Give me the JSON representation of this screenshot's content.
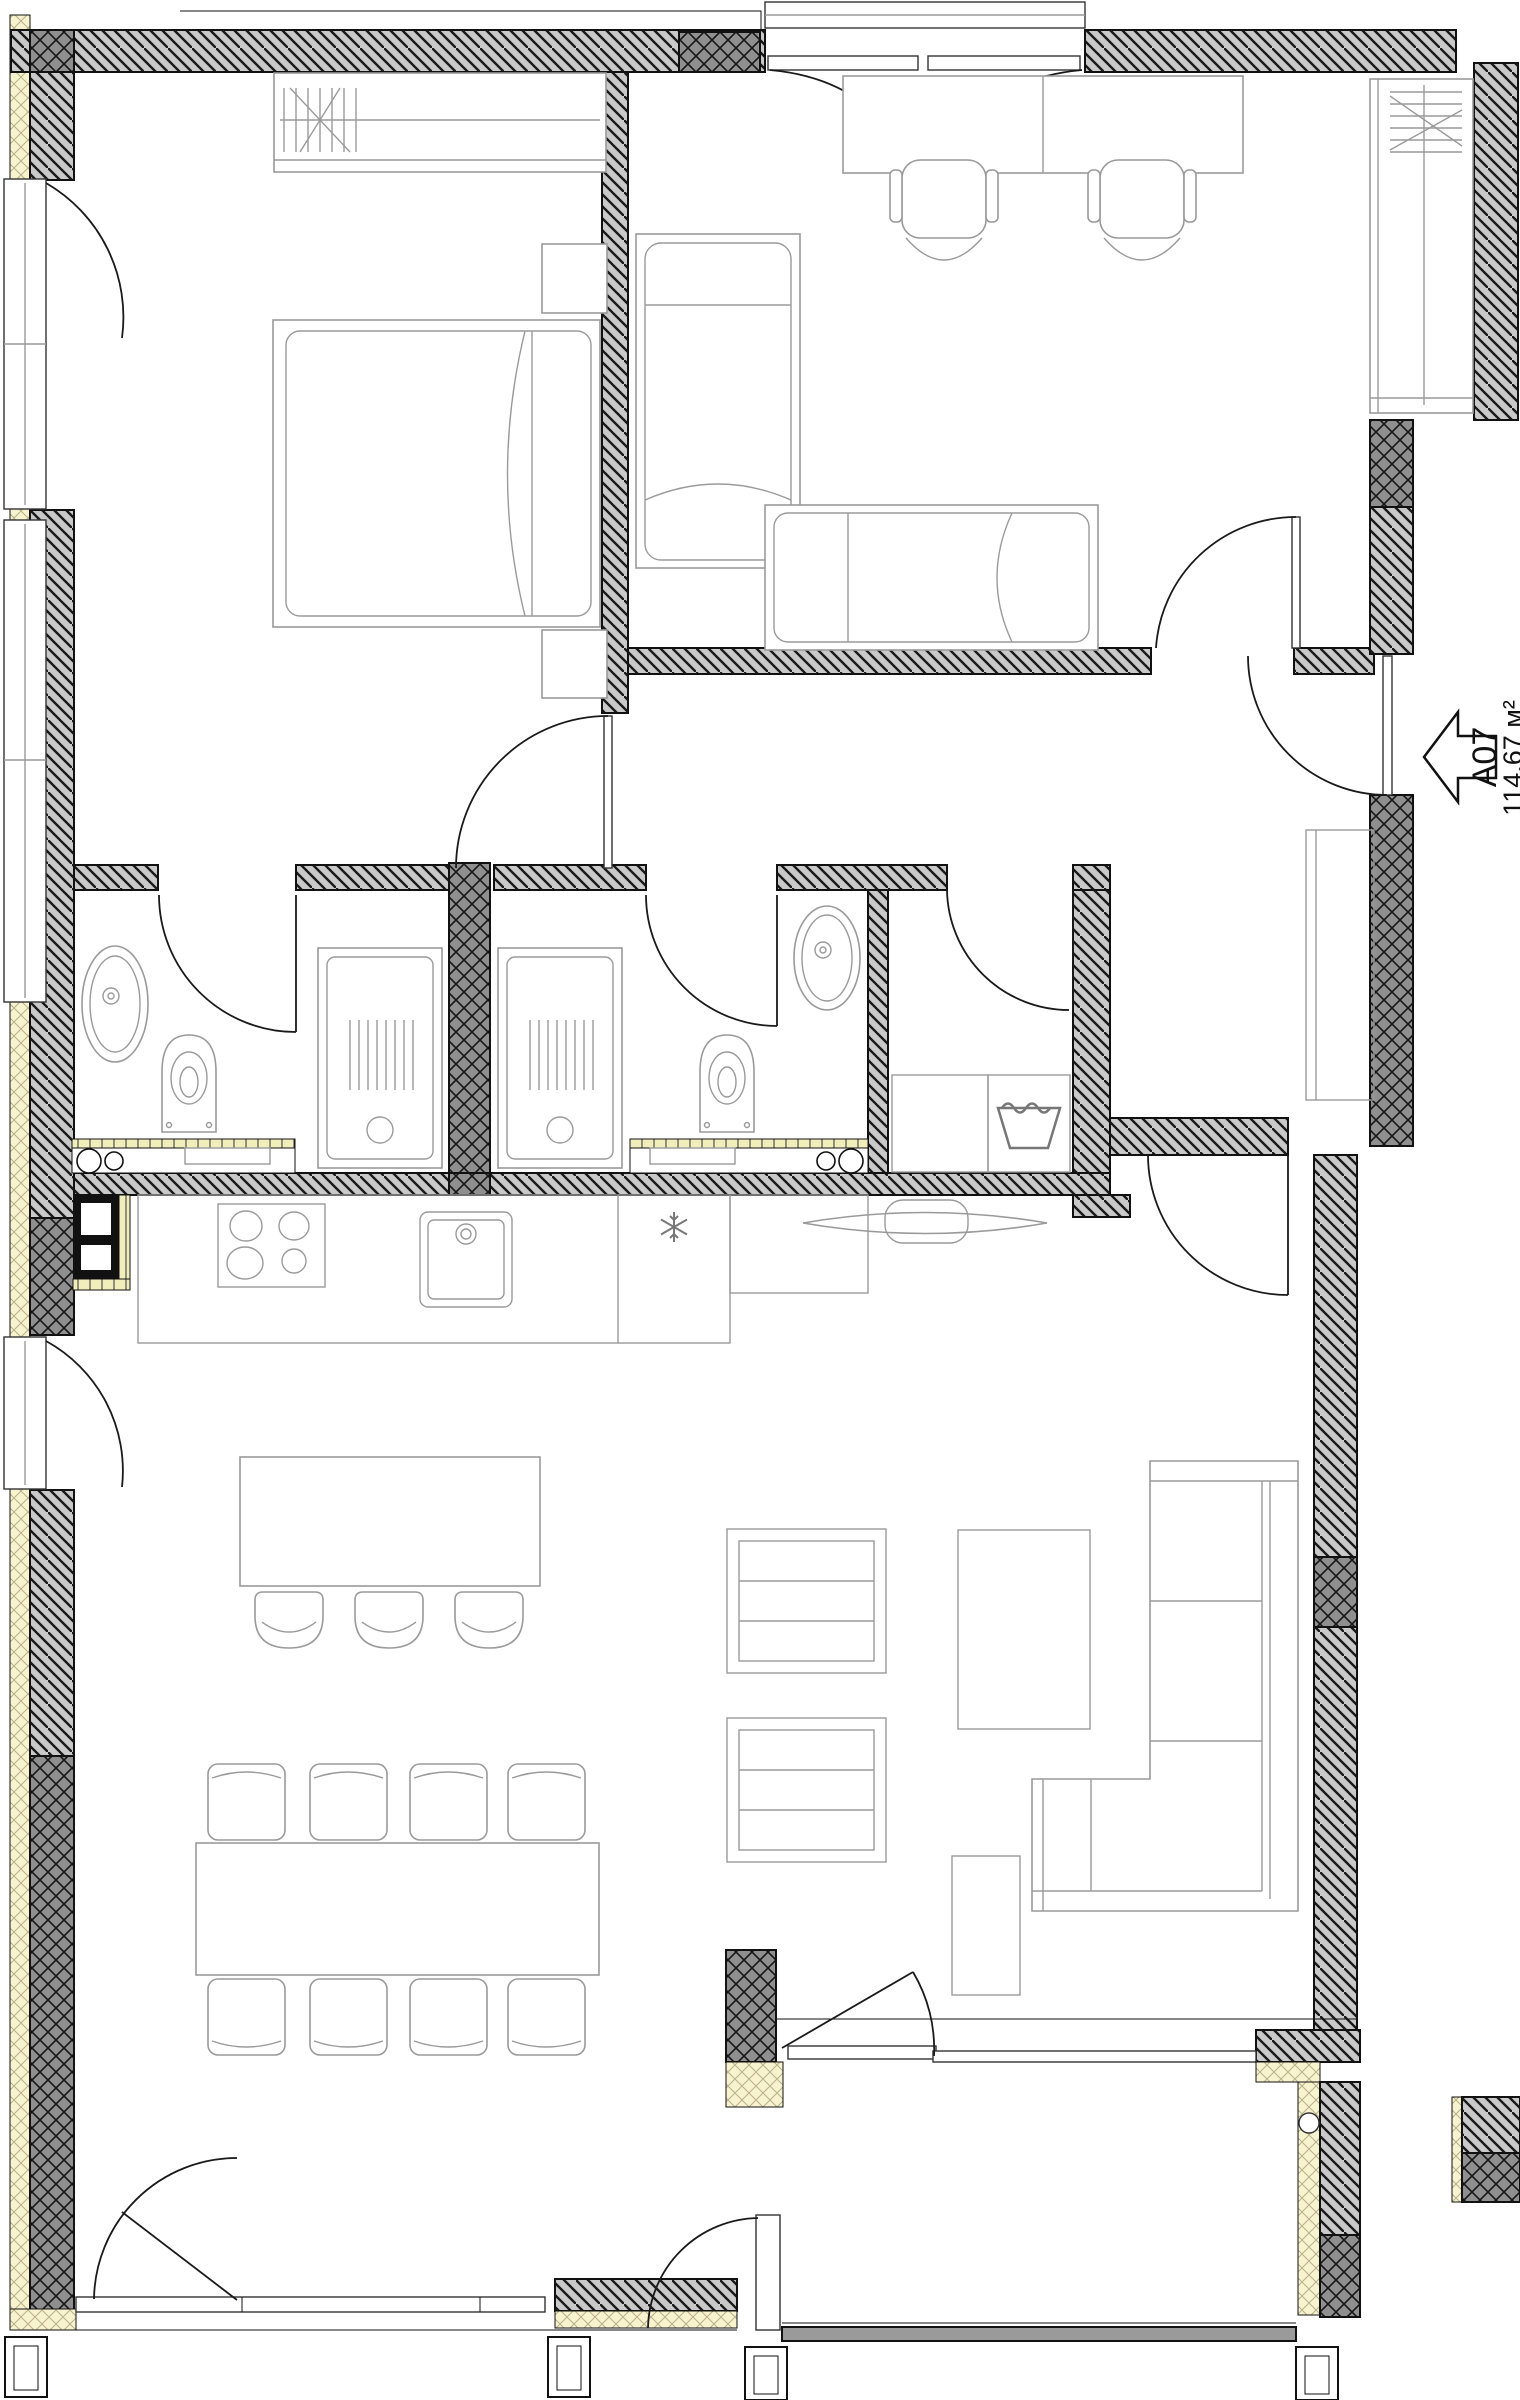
{
  "drawing": {
    "type": "architectural-floor-plan",
    "unit": {
      "id": "A07",
      "area_label": "114,67 м²"
    },
    "palette": {
      "wall_hatch_bg": "#c9c9c9",
      "concrete_block_bg": "#8f8f8f",
      "insulation_yellow": "#f7f3cf",
      "tile_band_yellow": "#f2eebc",
      "outline": "#111111",
      "furniture_line": "#9a9a9a",
      "terrace_edge_gray": "#9a9a9a"
    },
    "rooms": [
      {
        "name": "bedroom"
      },
      {
        "name": "kids-room"
      },
      {
        "name": "ensuite-bathroom"
      },
      {
        "name": "bathroom"
      },
      {
        "name": "laundry-room"
      },
      {
        "name": "hallway"
      },
      {
        "name": "kitchen"
      },
      {
        "name": "living-dining-room"
      },
      {
        "name": "terrace"
      }
    ],
    "icons": [
      {
        "name": "entrance-arrow",
        "meaning": "unit entrance marker",
        "text": "A07"
      },
      {
        "name": "snowflake-icon",
        "meaning": "refrigerator position"
      },
      {
        "name": "laundry-tub-icon",
        "meaning": "washing machine position"
      }
    ]
  }
}
